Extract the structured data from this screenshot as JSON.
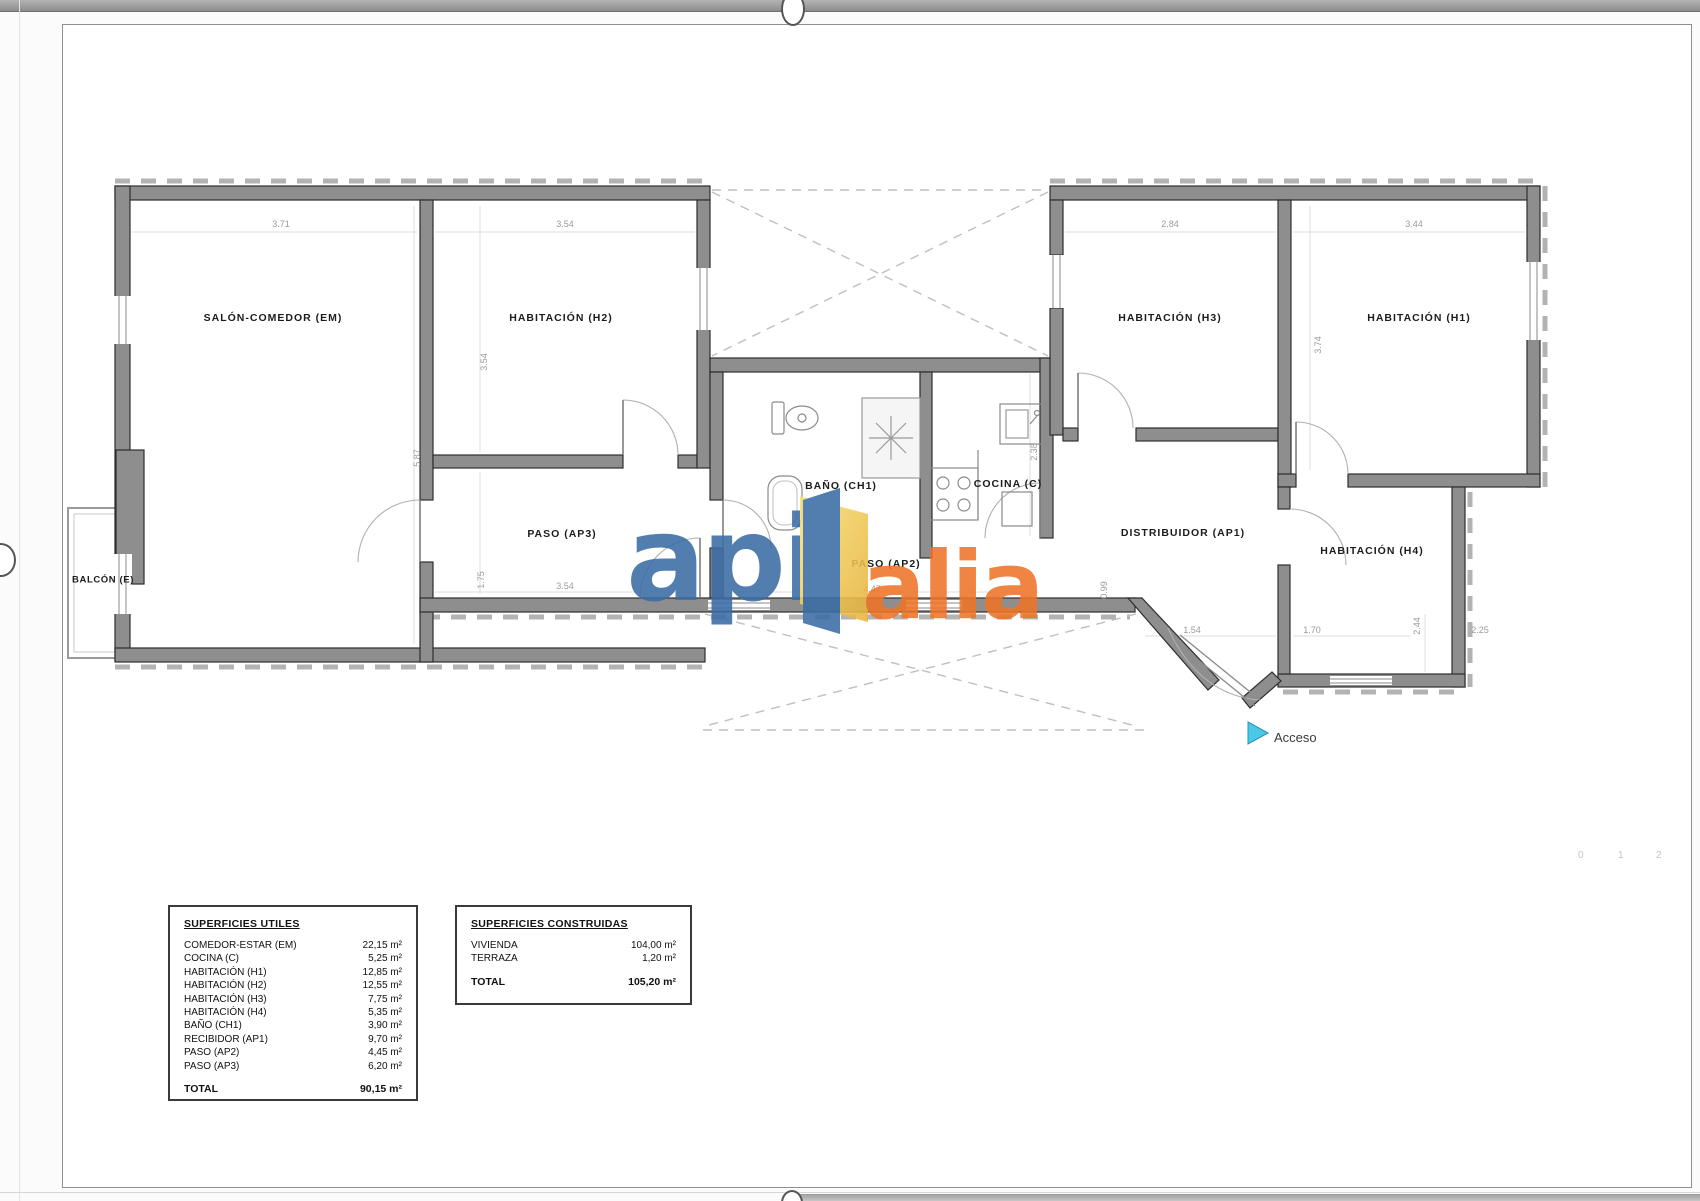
{
  "plan": {
    "rooms": {
      "salon": "SALÓN-COMEDOR (EM)",
      "h2": "HABITACIÓN (H2)",
      "h3": "HABITACIÓN (H3)",
      "h1": "HABITACIÓN (H1)",
      "bano": "BAÑO (CH1)",
      "cocina": "COCINA (C)",
      "paso3": "PASO (AP3)",
      "paso2": "PASO (AP2)",
      "distribuidor": "DISTRIBUIDOR (AP1)",
      "h4": "HABITACIÓN (H4)",
      "balcon": "BALCÓN (E)"
    },
    "access_label": "Acceso",
    "dims": {
      "d0": "3.71",
      "d1": "3.54",
      "d2": "2.84",
      "d3": "3.44",
      "d4": "5.87",
      "d5": "3.54",
      "d6": "1.75",
      "d7": "3.54",
      "d8": "4.47",
      "d9": "0.99",
      "d10": "1.54",
      "d11": "1.70",
      "d12": "2.44",
      "d13": "2.25",
      "d14": "3.74",
      "d15": "2.38"
    },
    "scale_bar": [
      "0",
      "1",
      "2"
    ]
  },
  "logo": {
    "word_blue": "api",
    "word_orange": "alia"
  },
  "colors": {
    "logo_blue": "#3a6da4",
    "logo_orange": "#ee7428",
    "logo_gold": "#f2cc45",
    "access_cyan": "#49c8e8",
    "wall_gray": "#8e8e8e"
  },
  "tables": {
    "useful": {
      "title": "SUPERFICIES UTILES",
      "rows": [
        {
          "label": "COMEDOR-ESTAR (EM)",
          "value": "22,15 m²"
        },
        {
          "label": "COCINA (C)",
          "value": "5,25 m²"
        },
        {
          "label": "HABITACIÓN (H1)",
          "value": "12,85 m²"
        },
        {
          "label": "HABITACIÓN (H2)",
          "value": "12,55 m²"
        },
        {
          "label": "HABITACIÓN (H3)",
          "value": "7,75 m²"
        },
        {
          "label": "HABITACIÓN (H4)",
          "value": "5,35 m²"
        },
        {
          "label": "BAÑO (CH1)",
          "value": "3,90 m²"
        },
        {
          "label": "RECIBIDOR (AP1)",
          "value": "9,70 m²"
        },
        {
          "label": "PASO (AP2)",
          "value": "4,45 m²"
        },
        {
          "label": "PASO (AP3)",
          "value": "6,20 m²"
        }
      ],
      "total_label": "TOTAL",
      "total_value": "90,15 m²"
    },
    "built": {
      "title": "SUPERFICIES CONSTRUIDAS",
      "rows": [
        {
          "label": "VIVIENDA",
          "value": "104,00 m²"
        },
        {
          "label": "TERRAZA",
          "value": "1,20 m²"
        }
      ],
      "total_label": "TOTAL",
      "total_value": "105,20 m²"
    }
  }
}
